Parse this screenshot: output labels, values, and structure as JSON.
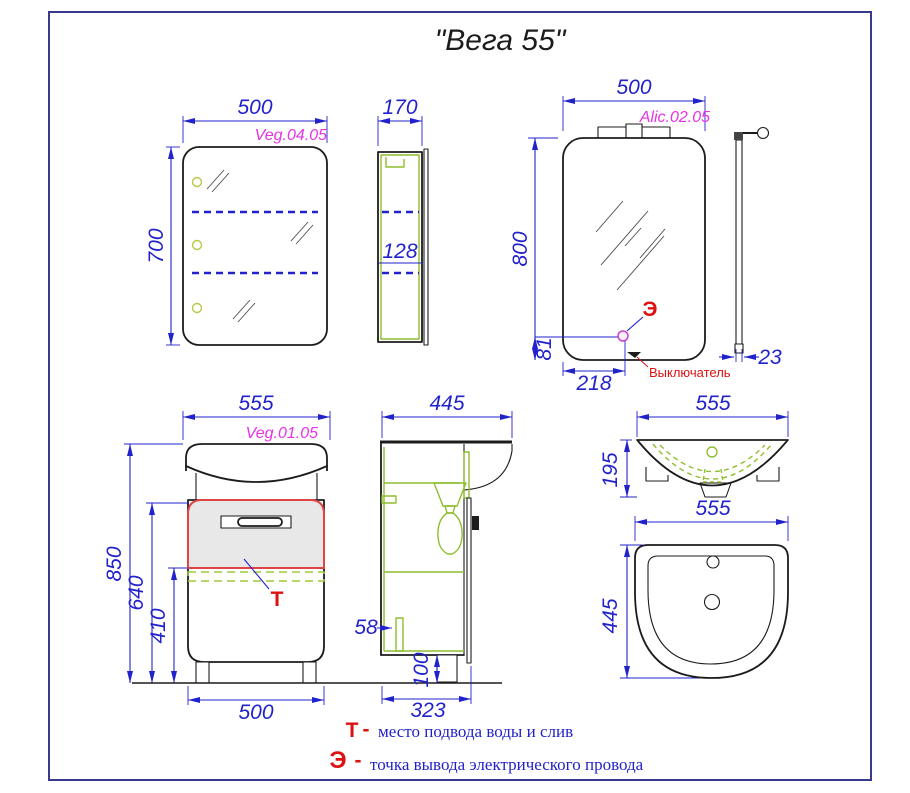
{
  "title": "\"Вега 55\"",
  "views": {
    "cabinet_front": {
      "code": "Veg.04.05",
      "dim_width": "500",
      "dim_height": "700"
    },
    "cabinet_side": {
      "dim_depth": "170",
      "dim_shelf": "128"
    },
    "mirror_front": {
      "code": "Alic.02.05",
      "dim_width": "500",
      "dim_height": "800",
      "dim_socket_bottom": "81",
      "dim_socket_left": "218",
      "socket_symbol": "Э",
      "switch_label": "Выключатель"
    },
    "mirror_side": {
      "dim_depth": "23"
    },
    "vanity_front": {
      "code": "Veg.01.05",
      "dim_width_top": "555",
      "dim_height": "850",
      "dim_drawer_top": "640",
      "dim_drawer_bottom": "410",
      "dim_width_bottom": "500",
      "zone_symbol": "Т"
    },
    "vanity_side": {
      "dim_depth": "445",
      "dim_shelf": "58",
      "dim_plinth": "100",
      "dim_depth_bottom": "323"
    },
    "sink_front": {
      "dim_width": "555",
      "dim_height": "195"
    },
    "sink_top": {
      "dim_width": "555",
      "dim_depth": "445"
    }
  },
  "legend": {
    "items": [
      {
        "symbol": "Т",
        "separator": "-",
        "text": "место подвода воды и слив"
      },
      {
        "symbol": "Э",
        "separator": "-",
        "text": "точка вывода электрического провода"
      }
    ]
  },
  "colors": {
    "dimension_blue": "#2222cc",
    "code_magenta": "#e633e6",
    "structure_green": "#8fbe2f",
    "annotation_red": "#dd1111",
    "zone_fill_gray": "#e9e8e8",
    "frame_navy": "#3a3a8c"
  }
}
